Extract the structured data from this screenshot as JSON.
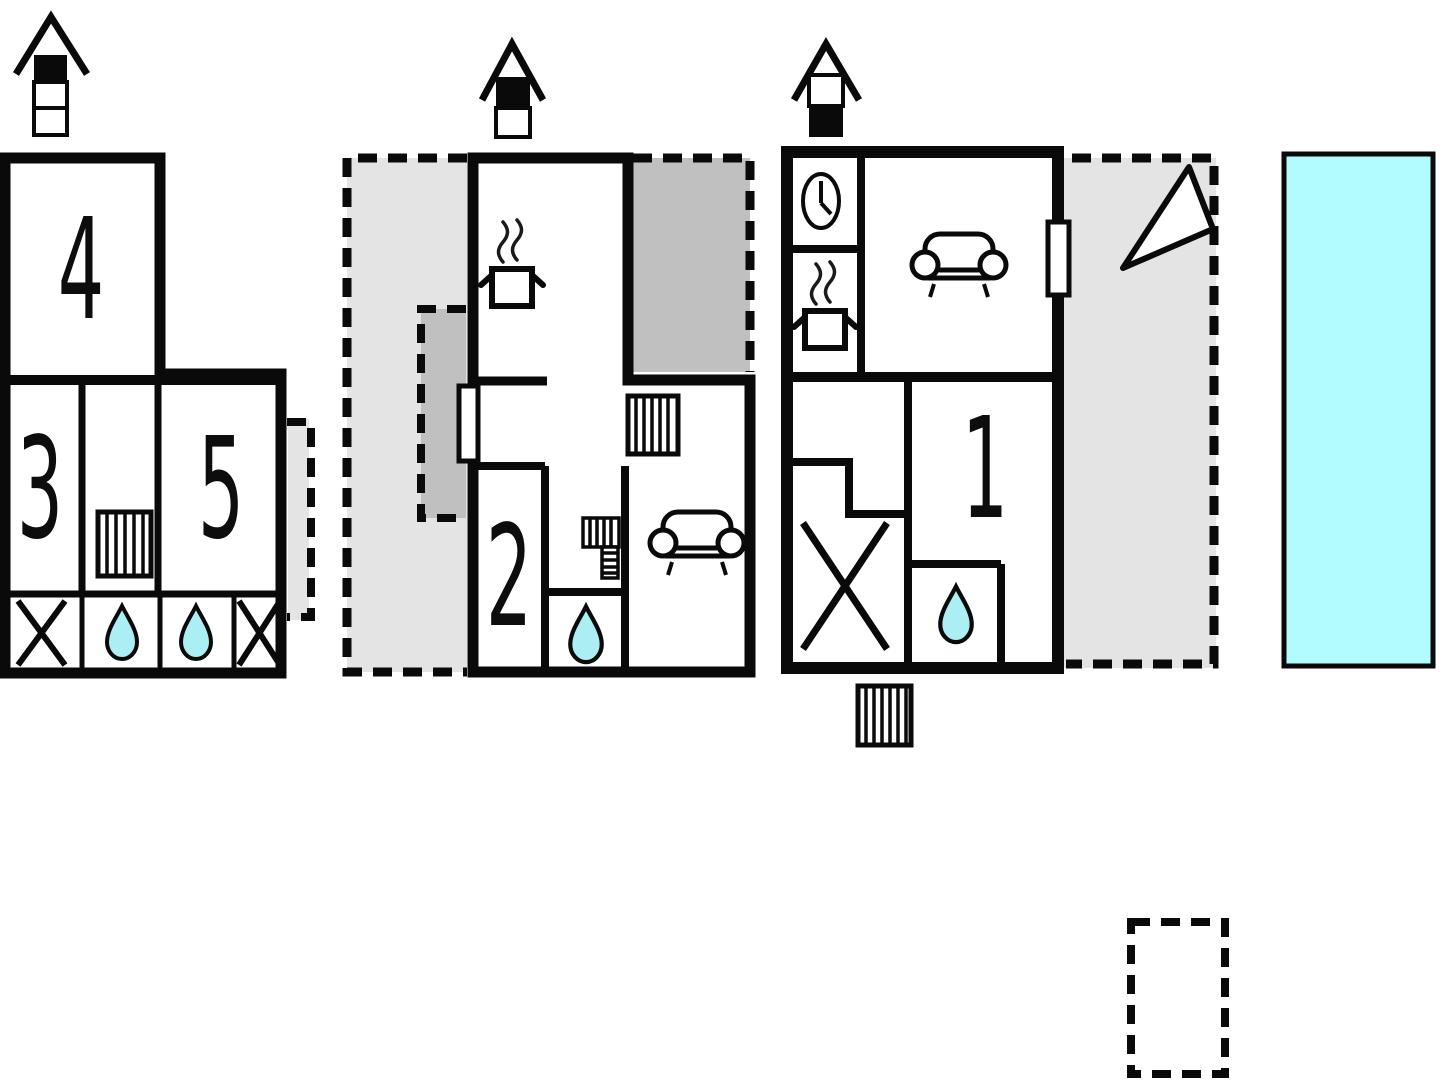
{
  "plan": {
    "rooms": [
      {
        "id": "room-1",
        "label": "1"
      },
      {
        "id": "room-2",
        "label": "2"
      },
      {
        "id": "room-3",
        "label": "3"
      },
      {
        "id": "room-4",
        "label": "4"
      },
      {
        "id": "room-5",
        "label": "5"
      }
    ]
  },
  "colors": {
    "wall": "#0a0a0a",
    "room_fill": "#ffffff",
    "terrace": "#e4e4e4",
    "covered_terrace": "#c0c0c0",
    "pool_water": "#b3fcfe",
    "water_drop": "#abeef3",
    "background": "#ffffff"
  },
  "icons": {
    "floor_marker_left": "house elevation, 3 levels, top level filled",
    "floor_marker_middle": "house elevation, 2 levels, upper level filled",
    "floor_marker_right": "house elevation, 2 levels, lower level filled",
    "stove": "cooking pot with steam",
    "clock": "clock face",
    "sofa": "sofa seen from above",
    "stairs": "striped stairs block",
    "water_drop": "water drop (bath/shower)",
    "x_mark": "diagonal cross (no access)",
    "compass_arrow": "triangular direction arrow",
    "window": "window opening",
    "pool": "swimming pool"
  }
}
